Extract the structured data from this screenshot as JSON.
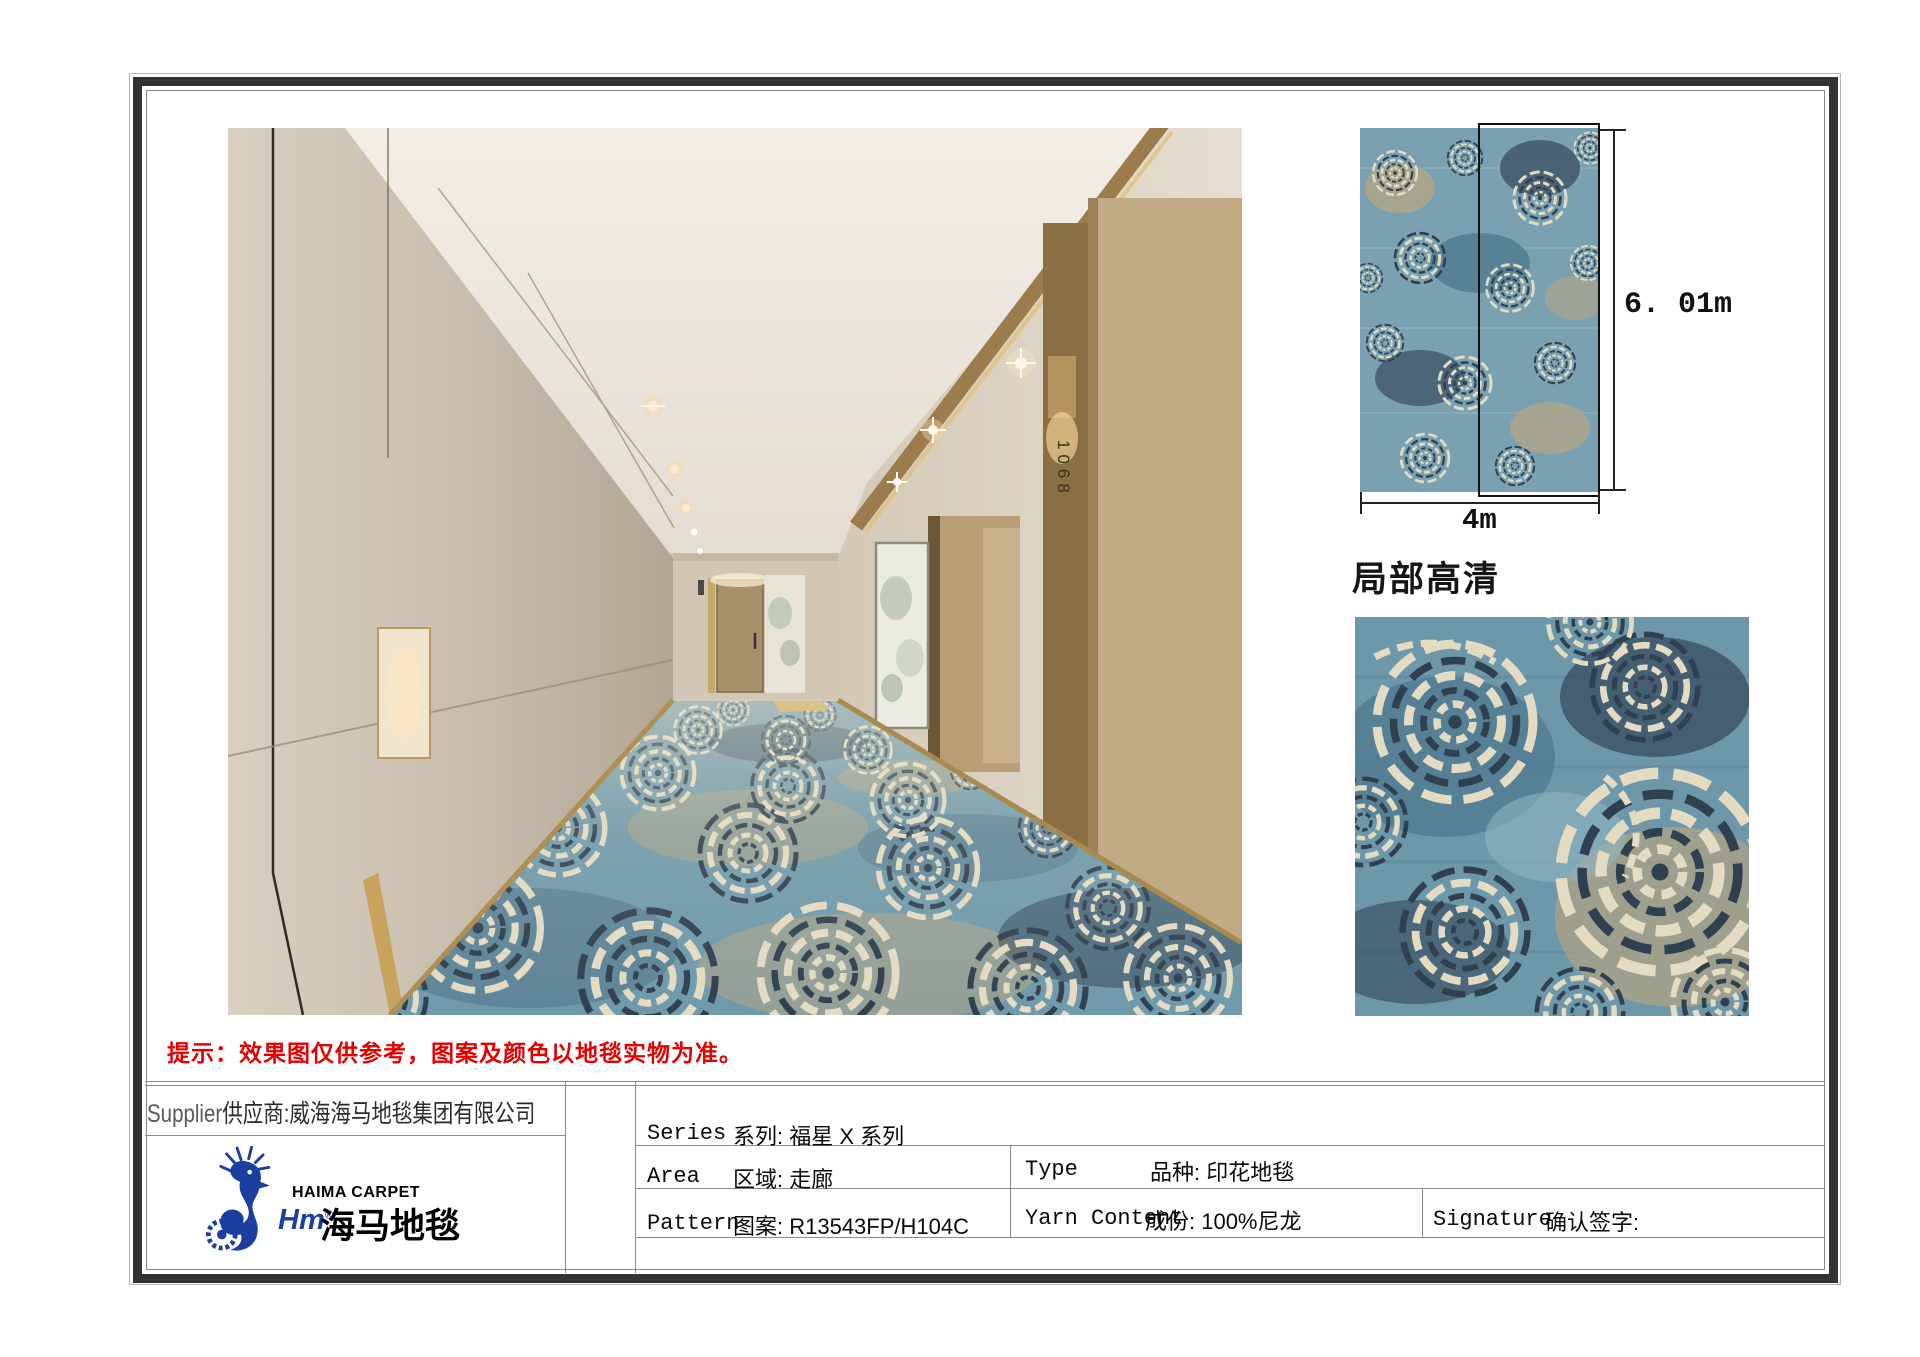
{
  "page": {
    "note_red": "提示：效果图仅供参考，图案及颜色以地毯实物为准。",
    "detail_label": "局部高清"
  },
  "dimensions": {
    "length": "6. 01m",
    "width": "4m"
  },
  "supplier": {
    "label_en": "Supplier",
    "label_cn": "供应商:威海海马地毯集团有限公司"
  },
  "logo": {
    "brand_en": "HAIMA CARPET",
    "brand_script": "Hm",
    "registered": "®",
    "brand_cn": "海马地毯"
  },
  "spec_table": {
    "series": {
      "en": "Series",
      "cn": "系列: 福星 X 系列"
    },
    "area": {
      "en": "Area",
      "cn": "区域: 走廊"
    },
    "pattern": {
      "en": "Pattern",
      "cn": "图案: R13543FP/H104C"
    },
    "type": {
      "en": "Type",
      "cn": "品种: 印花地毯"
    },
    "yarn": {
      "en": "Yarn Content",
      "cn": "成份: 100%尼龙"
    },
    "signature": {
      "en": "Signature",
      "cn": "确认签字:"
    }
  },
  "corridor": {
    "door_number": "1068"
  },
  "colors": {
    "note_red": "#e60000",
    "logo_blue": "#1c3ea0",
    "carpet_base": "#6f9aab",
    "carpet_cream": "#e4dbc3",
    "carpet_navy": "#2f4050",
    "frame_dark": "#333333"
  }
}
